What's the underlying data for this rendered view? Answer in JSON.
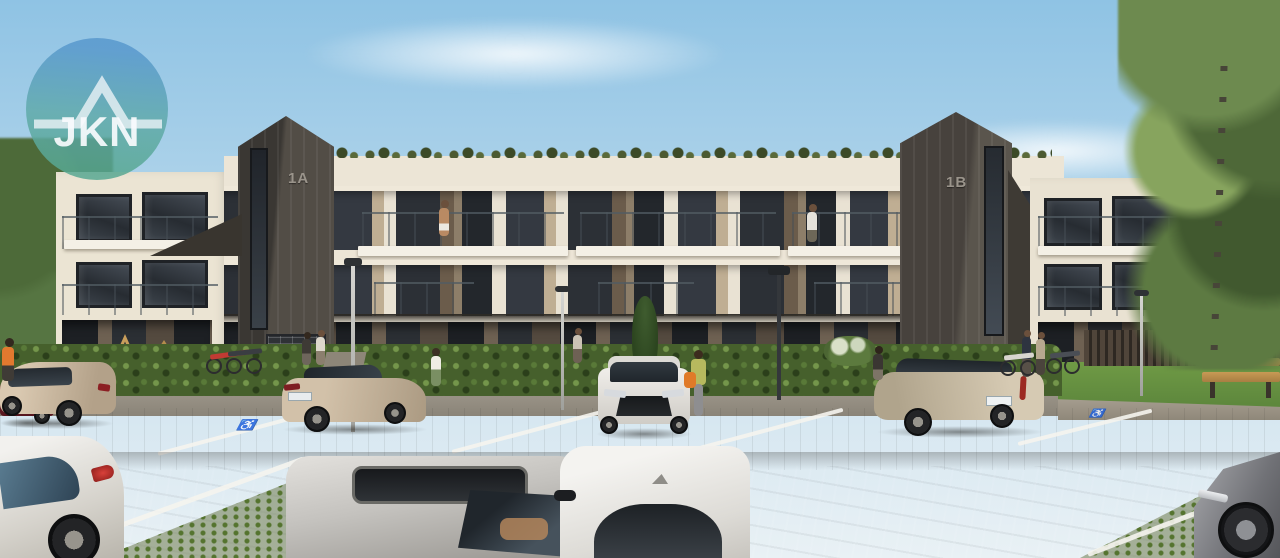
{
  "watermark": {
    "text": "JKN",
    "icon": "house-roof-icon",
    "circle_top_color": "#5898cd",
    "circle_bottom_color": "#58a892"
  },
  "building": {
    "tower_a_label": "1A",
    "tower_b_label": "1B",
    "facade_color": "#ece5d6",
    "tower_color": "#524d46",
    "window_color": "#2c3036",
    "floors": 3,
    "features": [
      "glass-balconies",
      "green-roof-tufts",
      "ground-floor-terraces"
    ]
  },
  "environment": {
    "sky_top": "#8fc3e4",
    "sky_horizon": "#e9f1f5",
    "hedge_color": "#46602c",
    "grass_color": "#6f9a45",
    "pavement_dark": "#5e5a54",
    "pavement_light": "#9b9281"
  },
  "site": {
    "accessible_marking": "♿",
    "bench": "wooden-bench",
    "bike_racks": 2,
    "lampposts": 4,
    "mailboxes": "wall-mailbox-panel",
    "playground": "wooden-play-frames"
  },
  "vehicles": [
    {
      "name": "dark-red-suv-far-left",
      "color": "#7d2833"
    },
    {
      "name": "beige-crossover-left",
      "color": "#c9b7a0"
    },
    {
      "name": "beige-sedan-parked",
      "color": "#c9b8a1"
    },
    {
      "name": "white-sedan-front-view",
      "color": "#f0eeea"
    },
    {
      "name": "beige-estate-right",
      "color": "#cdc2ad"
    },
    {
      "name": "white-sedan-foreground-left",
      "color": "#e3e1dd"
    },
    {
      "name": "silver-car-foreground",
      "color": "#c4c2be"
    },
    {
      "name": "white-car-foreground",
      "color": "#f4f3f0"
    },
    {
      "name": "grey-coupe-foreground-right",
      "color": "#717277"
    }
  ],
  "people": [
    {
      "name": "man-on-balcony-left"
    },
    {
      "name": "woman-on-balcony-right"
    },
    {
      "name": "woman-by-hedge"
    },
    {
      "name": "couple-walking-to-entrance"
    },
    {
      "name": "woman-with-orange-bag"
    },
    {
      "name": "woman-on-bench"
    },
    {
      "name": "pedestrians-near-bikes"
    },
    {
      "name": "woman-in-orange-left-edge"
    }
  ]
}
